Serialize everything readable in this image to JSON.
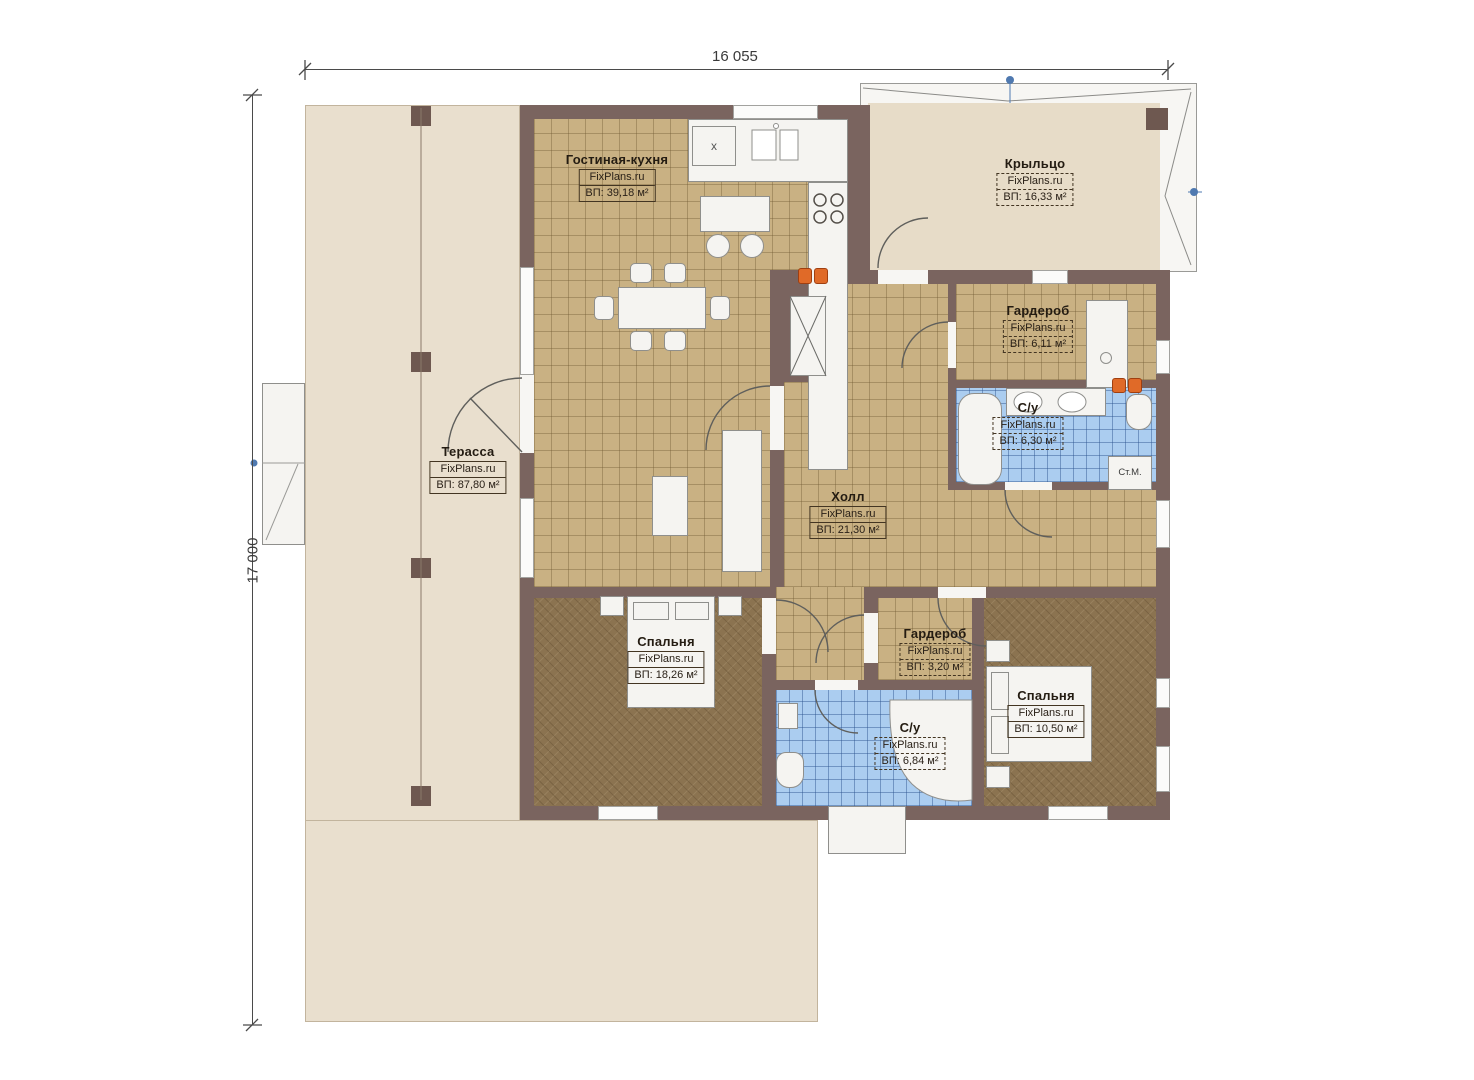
{
  "plan": {
    "dimensions": {
      "width": "16 055",
      "height": "17 000"
    },
    "rooms": [
      {
        "name": "Гостиная-кухня",
        "brand": "FixPlans.ru",
        "area": "ВП: 39,18 м²"
      },
      {
        "name": "Крыльцо",
        "brand": "FixPlans.ru",
        "area": "ВП: 16,33 м²"
      },
      {
        "name": "Гардероб",
        "brand": "FixPlans.ru",
        "area": "ВП: 6,11 м²"
      },
      {
        "name": "С/у",
        "brand": "FixPlans.ru",
        "area": "ВП: 6,30 м²"
      },
      {
        "name": "Терасса",
        "brand": "FixPlans.ru",
        "area": "ВП: 87,80 м²"
      },
      {
        "name": "Холл",
        "brand": "FixPlans.ru",
        "area": "ВП: 21,30 м²"
      },
      {
        "name": "Спальня",
        "brand": "FixPlans.ru",
        "area": "ВП: 18,26 м²"
      },
      {
        "name": "Гардероб",
        "brand": "FixPlans.ru",
        "area": "ВП: 3,20 м²"
      },
      {
        "name": "С/у",
        "brand": "FixPlans.ru",
        "area": "ВП: 6,84 м²"
      },
      {
        "name": "Спальня",
        "brand": "FixPlans.ru",
        "area": "ВП: 10,50 м²"
      }
    ],
    "fixtures": {
      "washing_machine": "Ст.М.",
      "fridge_mark": "x"
    },
    "colors": {
      "wall": "#7a645f",
      "tile_floor": "#c9b183",
      "carpet_floor": "#8b7350",
      "bath_floor": "#abcdf0",
      "outdoor": "#e9dfce",
      "radiator": "#e06a28"
    }
  }
}
